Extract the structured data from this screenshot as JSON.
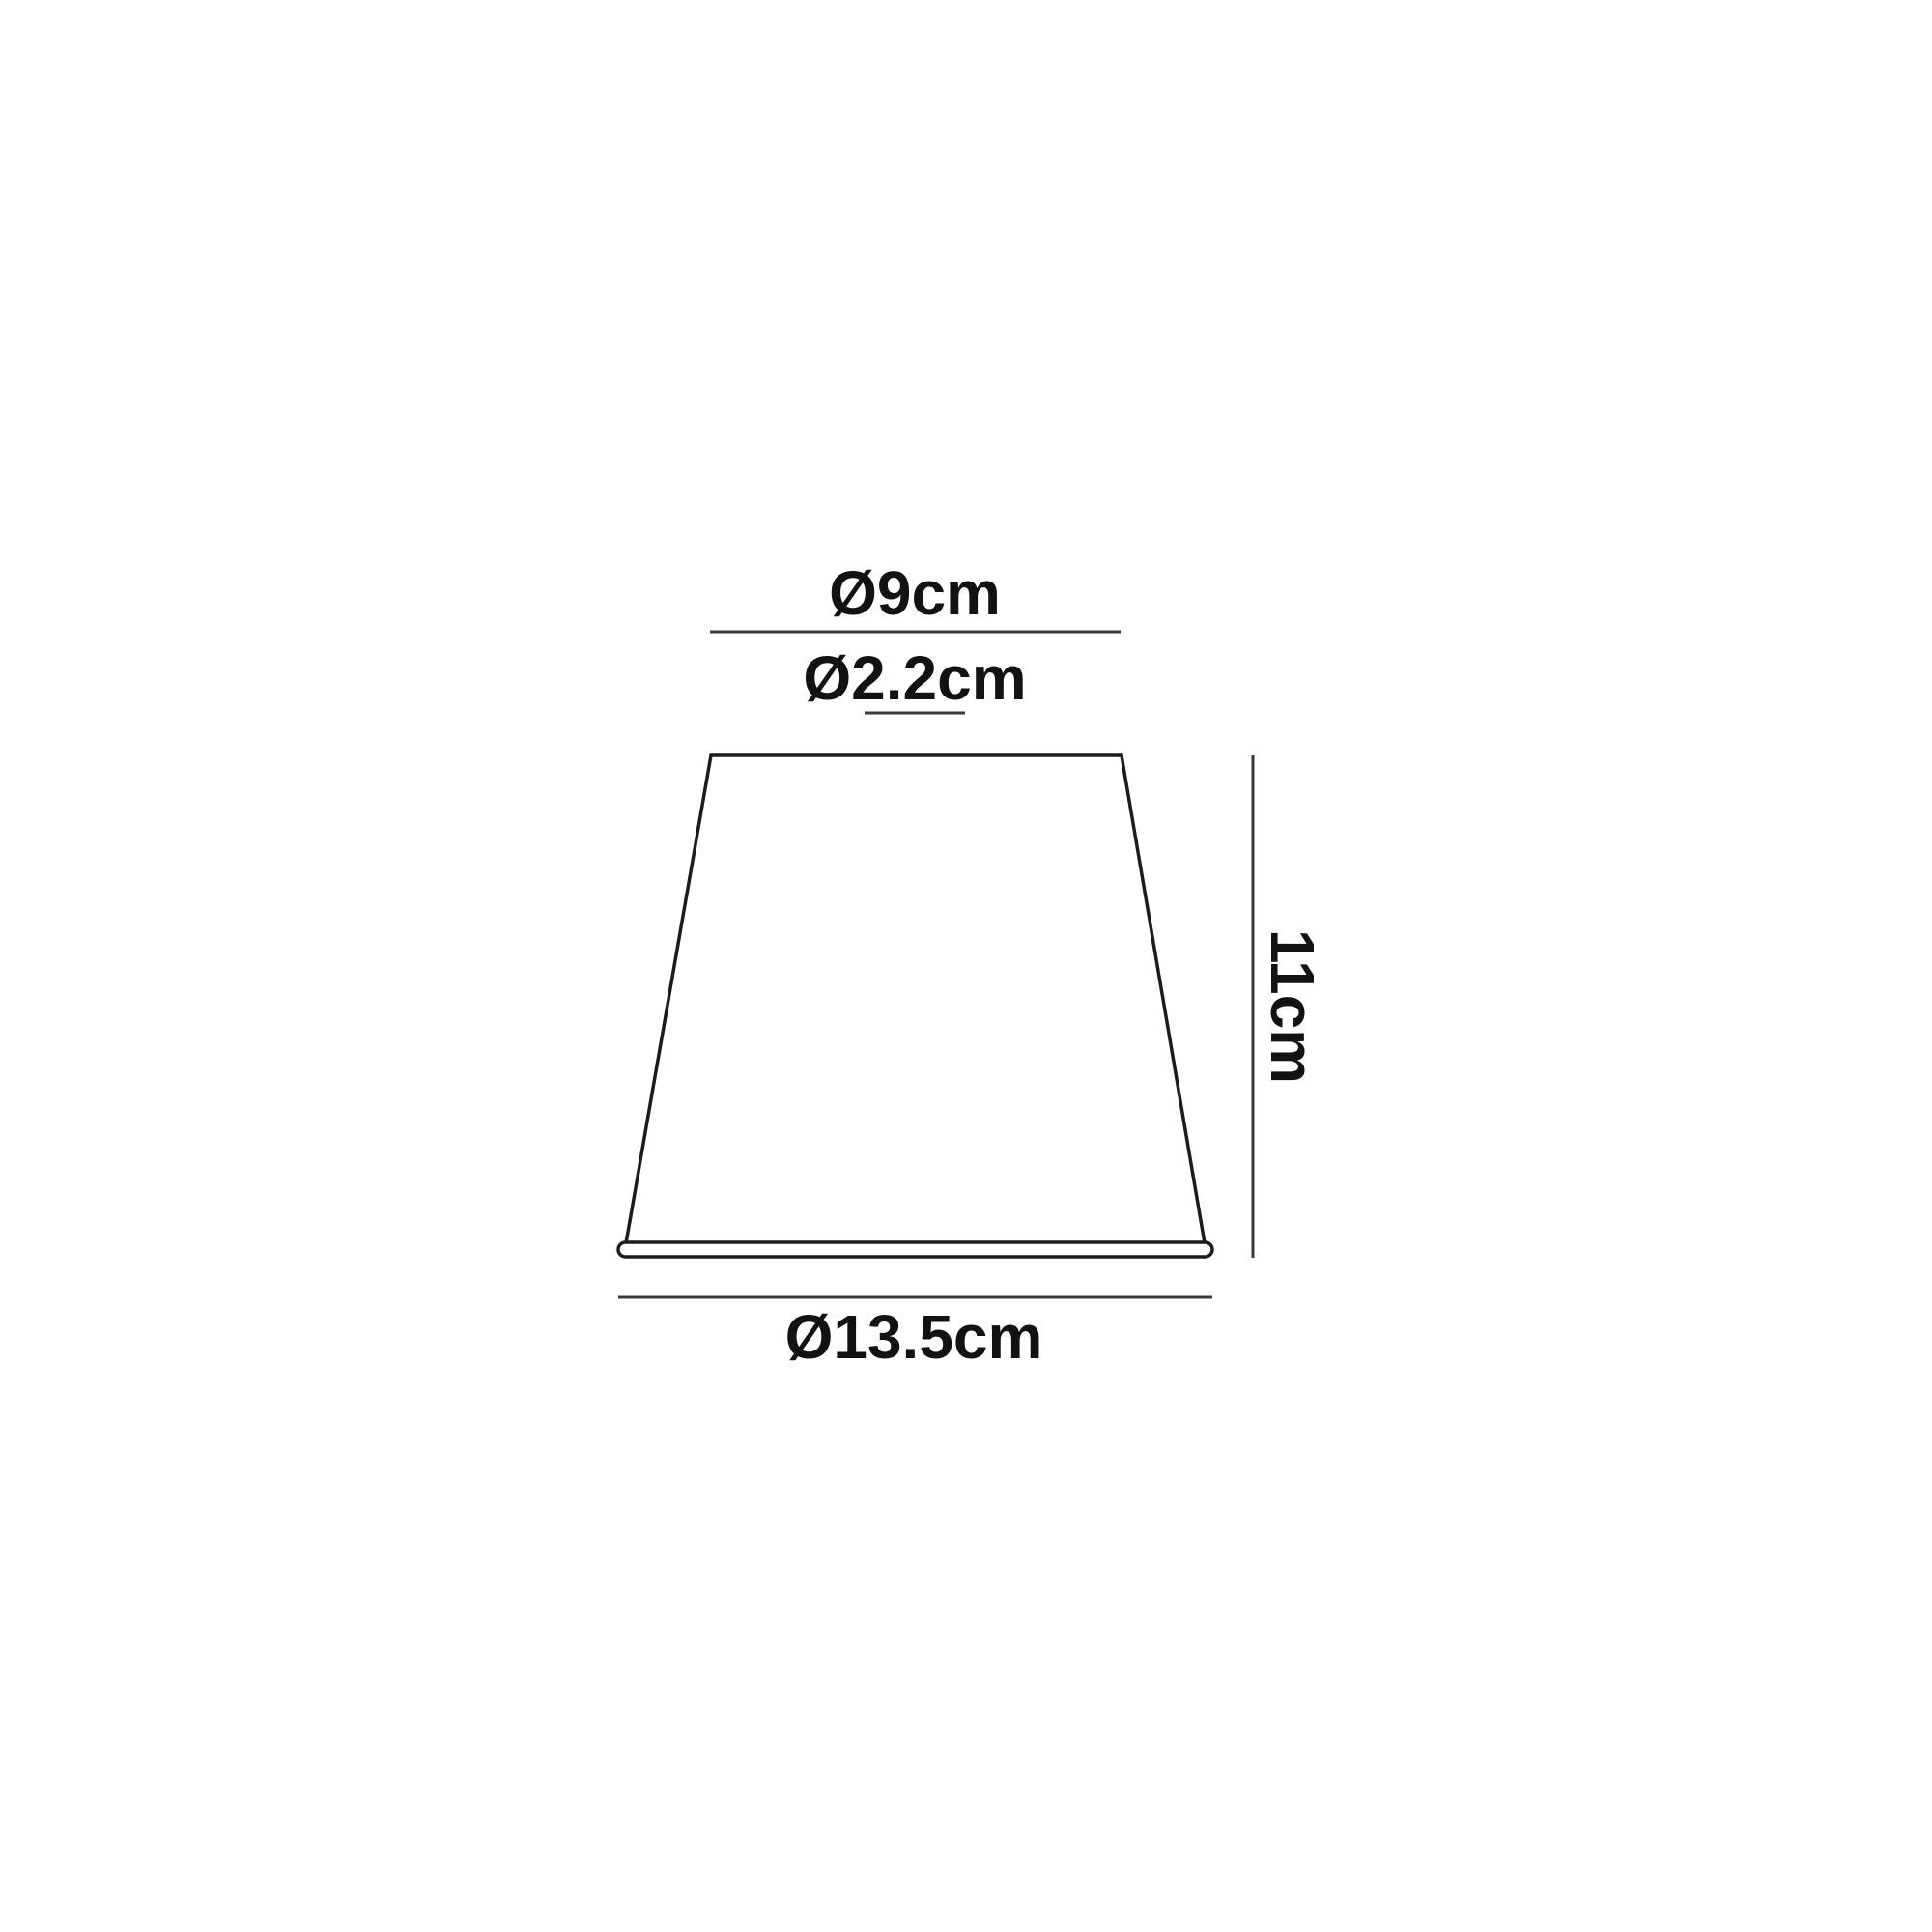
{
  "diagram": {
    "type": "lampshade-dimension-drawing",
    "labels": {
      "top_diameter": "Ø9cm",
      "fitter_diameter": "Ø2.2cm",
      "height": "11cm",
      "bottom_diameter": "Ø13.5cm"
    },
    "dimensions_cm": {
      "top_diameter": 9,
      "fitter_diameter": 2.2,
      "height": 11,
      "bottom_diameter": 13.5
    },
    "colors": {
      "background": "#ffffff",
      "outline": "#1c1c1c",
      "dimension_line": "#3a3a3a",
      "text": "#121212"
    }
  }
}
